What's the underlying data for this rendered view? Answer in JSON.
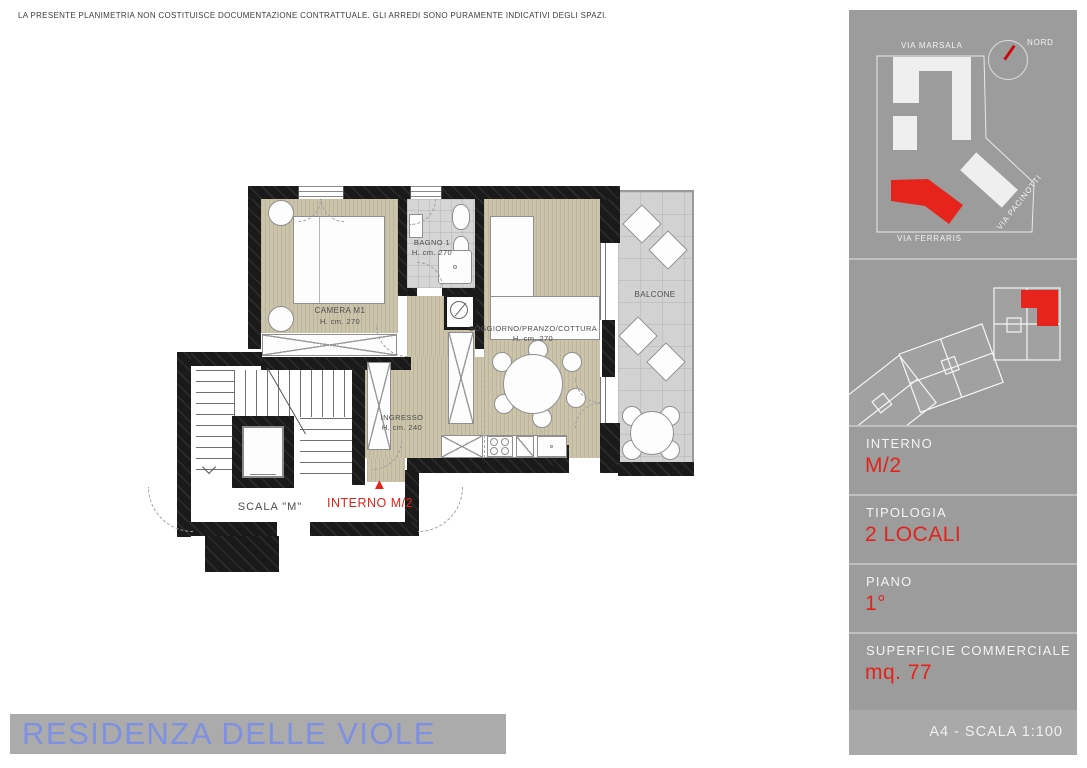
{
  "disclaimer": "LA PRESENTE PLANIMETRIA NON COSTITUISCE DOCUMENTAZIONE CONTRATTUALE. GLI ARREDI SONO PURAMENTE INDICATIVI DEGLI SPAZI.",
  "title": "RESIDENZA DELLE VIOLE",
  "plan": {
    "rooms": {
      "camera": {
        "name": "CAMERA M1",
        "height": "H. cm. 270"
      },
      "bagno": {
        "name": "BAGNO 1",
        "height": "H. cm. 270"
      },
      "soggiorno": {
        "name": "SOGGIORNO/PRANZO/COTTURA",
        "height": "H. cm. 270"
      },
      "ingresso": {
        "name": "INGRESSO",
        "height": "H. cm. 240"
      },
      "balcone": {
        "name": "BALCONE"
      },
      "scala": {
        "name": "SCALA \"M\""
      }
    },
    "entrance_label": "INTERNO M/2"
  },
  "icons": {
    "entrance_arrow": "▲"
  },
  "sidebar": {
    "site_map": {
      "streets": [
        "VIA MARSALA",
        "VIA FERRARIS",
        "VIA PACINOTTI"
      ],
      "compass": "NORD"
    },
    "info": [
      {
        "label": "INTERNO",
        "value": "M/2"
      },
      {
        "label": "TIPOLOGIA",
        "value": "2 LOCALI"
      },
      {
        "label": "PIANO",
        "value": "1°"
      },
      {
        "label": "SUPERFICIE COMMERCIALE",
        "value": "mq. 77"
      }
    ],
    "footer": "A4 - SCALA 1:100"
  },
  "colors": {
    "accent_red": "#e2231a",
    "title_blue": "#7d90e2",
    "sidebar_gray": "#9c9c9c",
    "floor_beige": "#cbc4aa",
    "tile_gray": "#d6d6d6",
    "wall_black": "#1a1a1a"
  }
}
